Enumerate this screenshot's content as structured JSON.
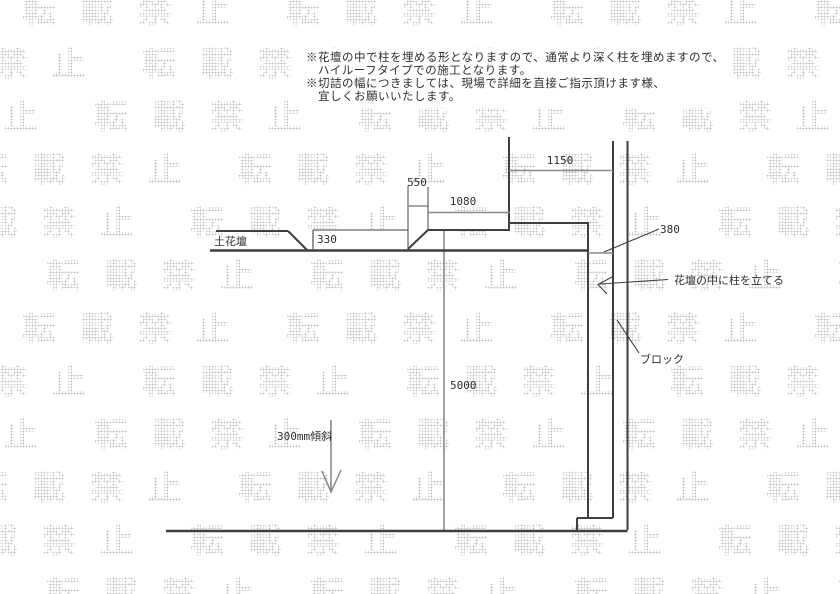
{
  "watermark": {
    "text": "転載禁止"
  },
  "notes": {
    "lines": [
      "※花壇の中で柱を埋める形となりますので、通常より深く柱を埋めますので、",
      "ハイルーフタイプでの施工となります。",
      "※切詰の幅につきましては、現場で詳細を直接ご指示頂けます様、",
      "宜しくお願いいたします。"
    ]
  },
  "diagram": {
    "dimensions": {
      "top_width": "1150",
      "step_width": "550",
      "beam_width": "1080",
      "soil_step": "330",
      "post_offset": "380",
      "depth": "5000",
      "slope": "300mm傾斜"
    },
    "labels": {
      "soil_bed": "土花壇",
      "pillar_note": "花壇の中に柱を立てる",
      "block": "ブロック"
    }
  },
  "colors": {
    "line_dark": "#3f3f3f",
    "line_gray": "#8a8a8a",
    "text_color": "#2e2e2e",
    "watermark_color": "#c3c3c3"
  }
}
